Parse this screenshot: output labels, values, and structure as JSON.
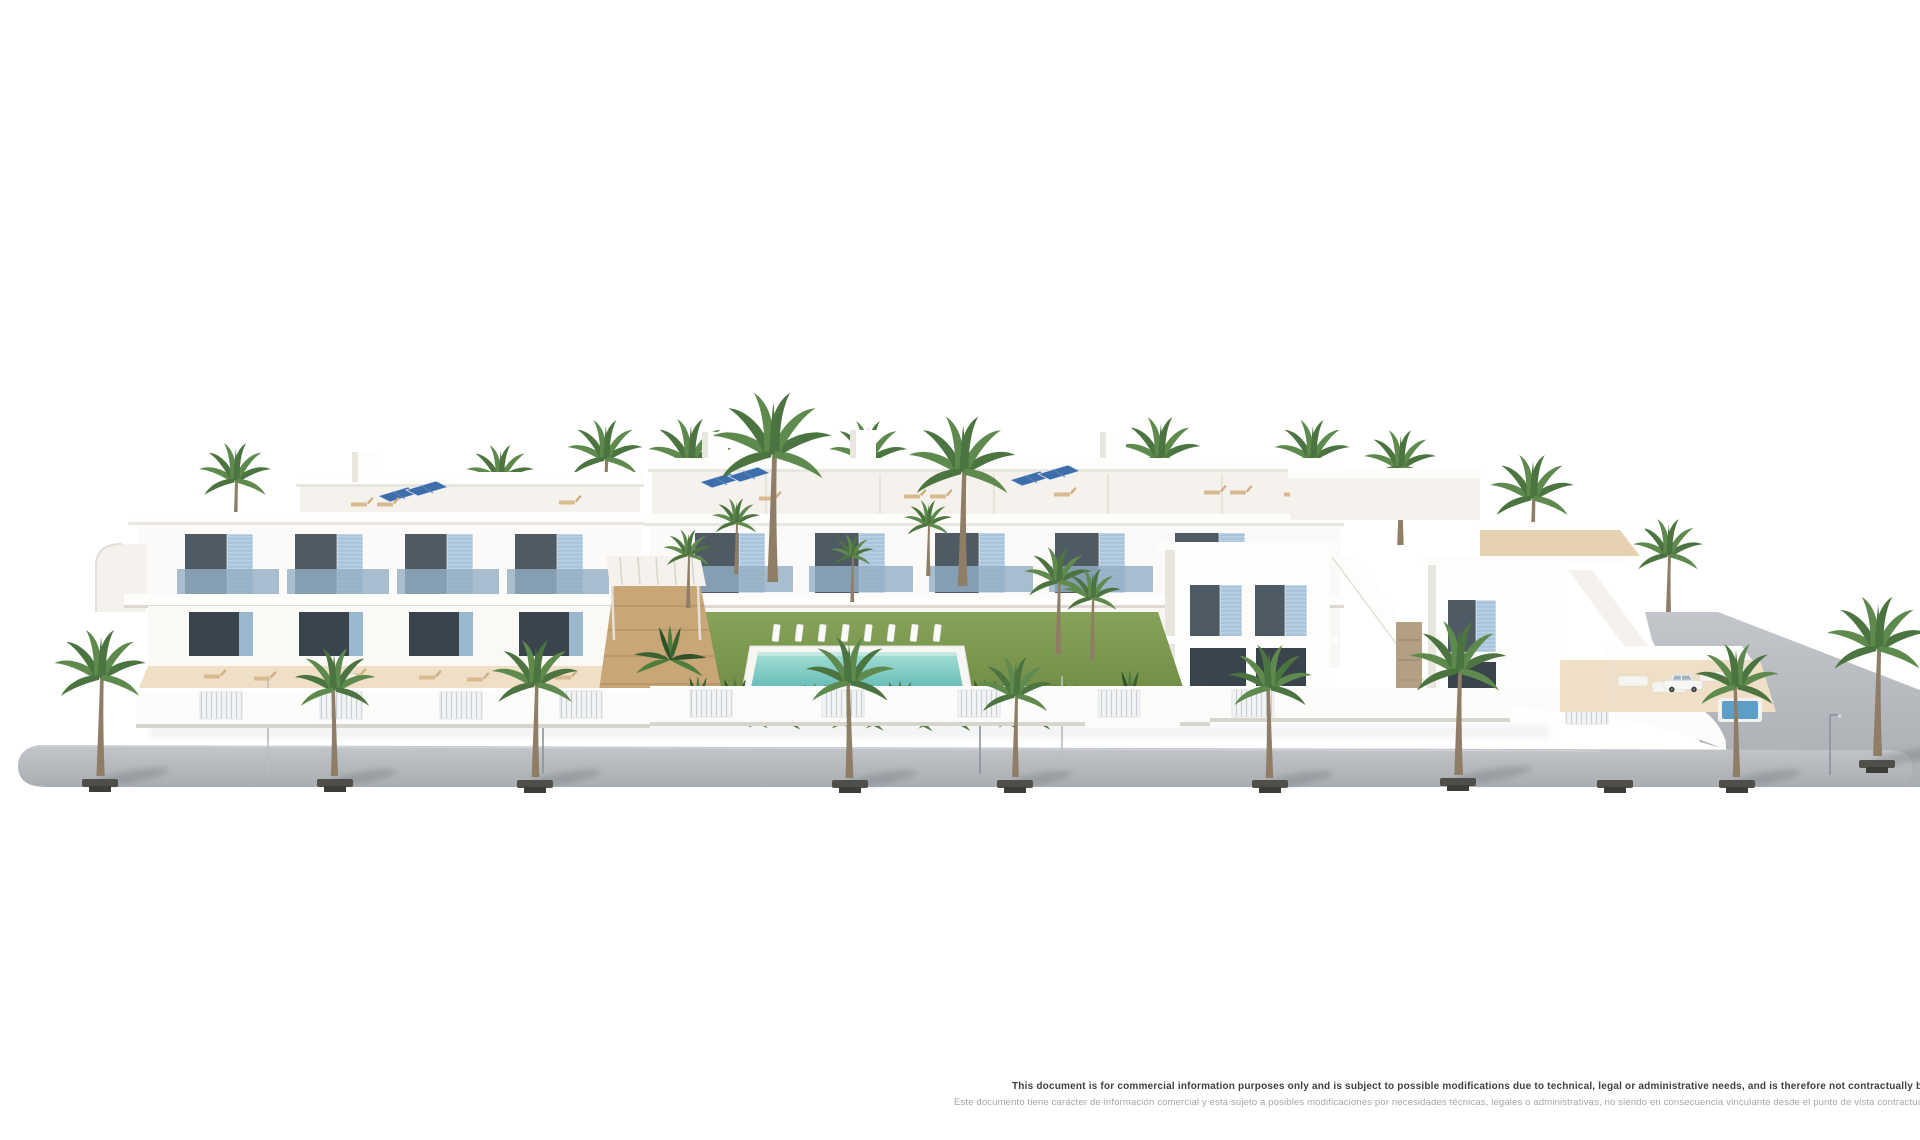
{
  "page": {
    "width": 1920,
    "height": 1140,
    "background": "#ffffff"
  },
  "disclaimer": {
    "line1_en": "This document is for commercial information purposes only and is subject to possible modifications due to technical, legal or administrative needs, and is therefore not contractually binding.",
    "line2_es": "Este documento tiene carácter de información comercial y está sujeto a posibles modificaciones por necesidades técnicas, legales o administrativas, no siendo en consecuencia vinculante desde el punto de vista contractual.",
    "color_en": "#3f3f3f",
    "color_es": "#a6a6a6"
  },
  "render": {
    "description": "3D architectural render of a white Mediterranean residential complex with blue shutters, solar panels, palm trees, communal lawn garden with swimming pool and a grey street promenade",
    "colors": {
      "wall_white": "#fdfdfc",
      "wall_shade": "#e9e5df",
      "shutter_blue": "#a9c4dd",
      "balcony_glass": "#93afc4",
      "solar_blue": "#3e6dab",
      "lawn_green": "#7d9b50",
      "pool_teal": "#6fbfbb",
      "road_grey": "#b6bac0",
      "sand_terrace": "#eedfc6",
      "stone_beige": "#b3a083",
      "palm_green": "#4c7440"
    },
    "scene": {
      "street_palms": [
        [
          100,
          776,
          1.12,
          1
        ],
        [
          335,
          776,
          0.98,
          -1
        ],
        [
          535,
          777,
          1.05,
          1
        ],
        [
          850,
          778,
          1.08,
          -1
        ],
        [
          1015,
          777,
          0.92,
          1
        ],
        [
          1270,
          778,
          1.02,
          -1
        ],
        [
          1458,
          775,
          1.18,
          1
        ],
        [
          1737,
          777,
          1.02,
          -1
        ],
        [
          1877,
          756,
          1.22,
          1
        ]
      ],
      "back_palms": [
        [
          235,
          558,
          0.88
        ],
        [
          500,
          552,
          0.82
        ],
        [
          605,
          540,
          0.92
        ],
        [
          690,
          552,
          1.02
        ],
        [
          868,
          545,
          0.95
        ],
        [
          1160,
          545,
          0.98
        ],
        [
          1312,
          540,
          0.92
        ],
        [
          1400,
          545,
          0.88
        ],
        [
          1532,
          588,
          1.02
        ],
        [
          1668,
          630,
          0.85
        ]
      ],
      "garden_palms": [
        [
          772,
          582,
          1.45
        ],
        [
          962,
          586,
          1.3
        ],
        [
          688,
          608,
          0.6
        ],
        [
          852,
          602,
          0.52
        ],
        [
          736,
          574,
          0.58
        ],
        [
          928,
          576,
          0.58
        ],
        [
          1058,
          654,
          0.82
        ],
        [
          1092,
          660,
          0.7
        ]
      ],
      "plants": [
        [
          698,
          706
        ],
        [
          735,
          712
        ],
        [
          775,
          717
        ],
        [
          815,
          713
        ],
        [
          858,
          718
        ],
        [
          900,
          715
        ],
        [
          945,
          717
        ],
        [
          985,
          713
        ],
        [
          1025,
          717
        ],
        [
          1065,
          713
        ],
        [
          1105,
          715
        ],
        [
          670,
          660
        ],
        [
          1130,
          700
        ]
      ],
      "red_flowers": [
        [
          846,
          715
        ],
        [
          1146,
          714
        ]
      ],
      "tree_pits": [
        [
          100,
          779
        ],
        [
          335,
          779
        ],
        [
          535,
          780
        ],
        [
          850,
          780
        ],
        [
          1015,
          780
        ],
        [
          1270,
          780
        ],
        [
          1458,
          778
        ],
        [
          1615,
          780
        ],
        [
          1737,
          780
        ],
        [
          1877,
          760
        ]
      ],
      "lamps": [
        [
          543,
          773
        ],
        [
          980,
          774
        ],
        [
          1830,
          775
        ]
      ],
      "posts": [
        [
          268,
          772
        ],
        [
          1062,
          771
        ]
      ],
      "solar_panels": [
        [
          196,
          552
        ],
        [
          224,
          546
        ],
        [
          468,
          552
        ],
        [
          496,
          546
        ],
        [
          378,
          496
        ],
        [
          406,
          490
        ],
        [
          700,
          482
        ],
        [
          728,
          476
        ],
        [
          1010,
          480
        ],
        [
          1038,
          474
        ],
        [
          1160,
          541
        ]
      ],
      "roof_loungers": [
        [
          352,
          506
        ],
        [
          378,
          506
        ],
        [
          560,
          504
        ],
        [
          760,
          500
        ],
        [
          905,
          498
        ],
        [
          931,
          498
        ],
        [
          1055,
          496
        ],
        [
          1205,
          494
        ],
        [
          1231,
          494
        ],
        [
          1285,
          496
        ],
        [
          1520,
          547
        ],
        [
          1562,
          544
        ]
      ],
      "terrace_loungers": [
        [
          205,
          678
        ],
        [
          255,
          680
        ],
        [
          345,
          677
        ],
        [
          420,
          679
        ],
        [
          468,
          681
        ],
        [
          556,
          679
        ]
      ],
      "left_bays": [
        185,
        295,
        405,
        515
      ],
      "center_bays": [
        695,
        815,
        935,
        1055,
        1175
      ],
      "pool_loungers": {
        "x0": 772,
        "y": 640,
        "n": 8,
        "dx": 23
      },
      "fence_segments": [
        [
          200,
          692
        ],
        [
          320,
          692
        ],
        [
          440,
          692
        ],
        [
          560,
          691
        ],
        [
          690,
          690
        ],
        [
          822,
          690
        ],
        [
          958,
          690
        ],
        [
          1098,
          690
        ],
        [
          1232,
          690
        ],
        [
          1566,
          697
        ]
      ],
      "cars": [
        [
          "white",
          1100,
          716,
          1
        ],
        [
          "dark",
          534,
          721,
          0.9
        ],
        [
          "white",
          1664,
          690,
          0.6
        ]
      ]
    }
  }
}
